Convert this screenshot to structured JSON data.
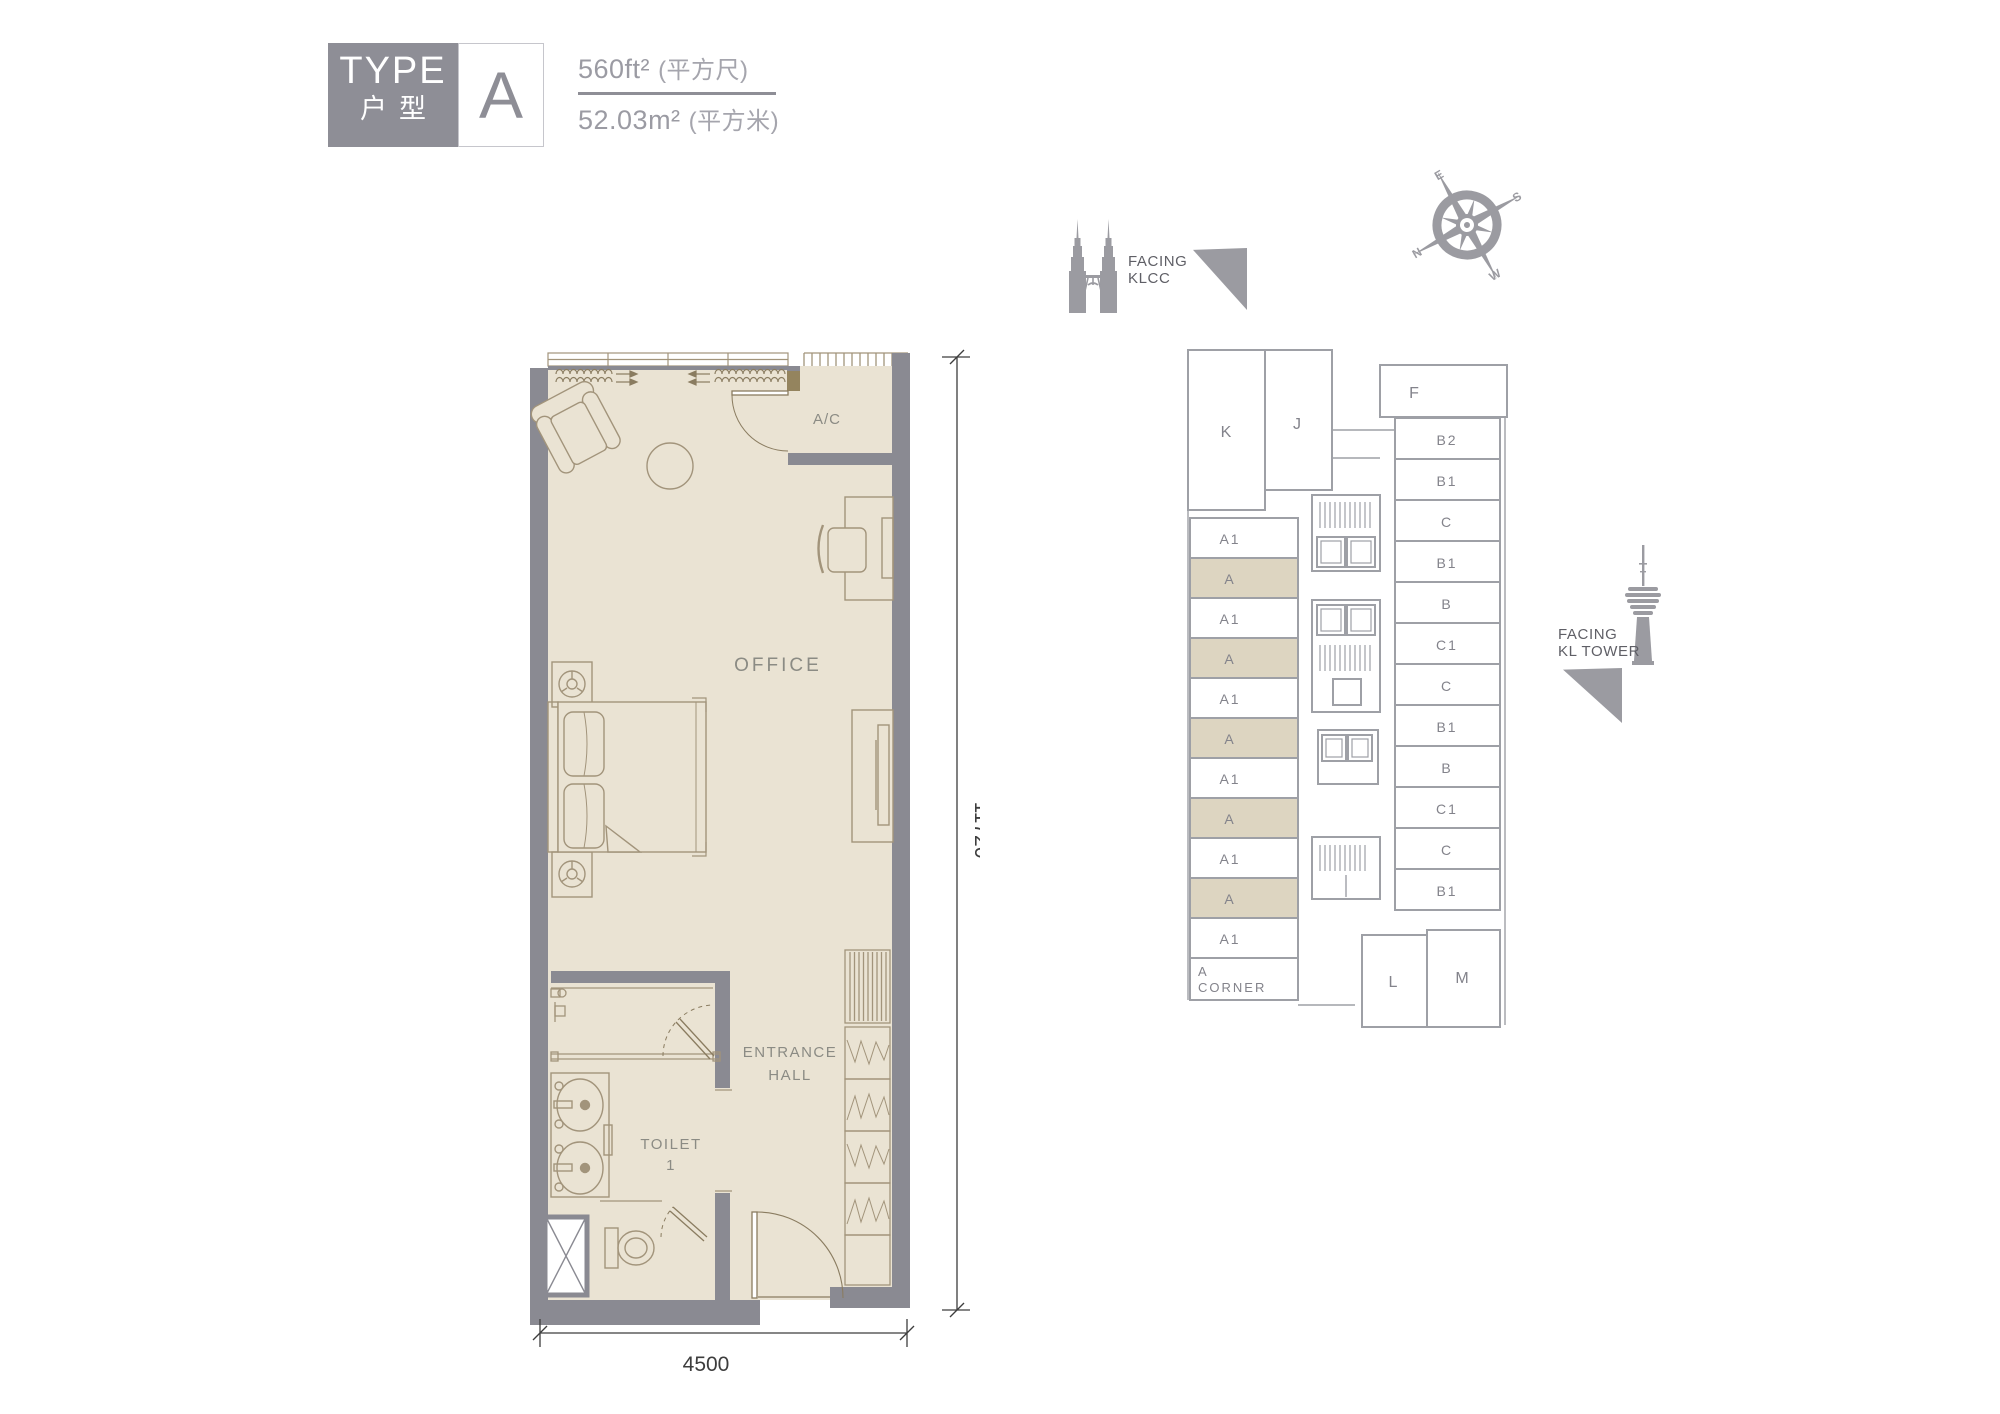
{
  "title_block": {
    "type_label": "TYPE",
    "type_label_cn": "户型",
    "unit_type": "A",
    "area_sqft": "560ft²",
    "area_sqft_unit": "(平方尺)",
    "area_sqm": "52.03m²",
    "area_sqm_unit": "(平方米)"
  },
  "orientation": {
    "facing_klcc_line1": "FACING",
    "facing_klcc_line2": "KLCC",
    "facing_kl_tower_line1": "FACING",
    "facing_kl_tower_line2": "KL TOWER",
    "compass": {
      "n": "N",
      "e": "E",
      "s": "S",
      "w": "W"
    }
  },
  "floor_plan": {
    "room_labels": {
      "ac": "A/C",
      "office": "OFFICE",
      "entrance_hall_line1": "ENTRANCE",
      "entrance_hall_line2": "HALL",
      "toilet_line1": "TOILET",
      "toilet_line2": "1"
    },
    "dimensions": {
      "width_mm": "4500",
      "depth_mm": "11720"
    }
  },
  "key_plan": {
    "blocks": {
      "k": "K",
      "j": "J",
      "f": "F",
      "l": "L",
      "m": "M"
    },
    "left_units": [
      "A1",
      "A",
      "A1",
      "A",
      "A1",
      "A",
      "A1",
      "A",
      "A1",
      "A",
      "A1"
    ],
    "right_units": [
      "B2",
      "B1",
      "C",
      "B1",
      "B",
      "C1",
      "C",
      "B1",
      "B",
      "C1",
      "C",
      "B1"
    ],
    "corner_unit_line1": "A",
    "corner_unit_line2": "CORNER",
    "highlight_color": "#ddd5c1"
  },
  "colors": {
    "wall_gray": "#8a8a92",
    "interior_beige": "#eae3d3",
    "furniture_line": "#a2947b",
    "type_a_highlight": "#ddd5c1",
    "keyplan_line": "#9ea0a6",
    "icon_gray": "#9b9ba1"
  }
}
